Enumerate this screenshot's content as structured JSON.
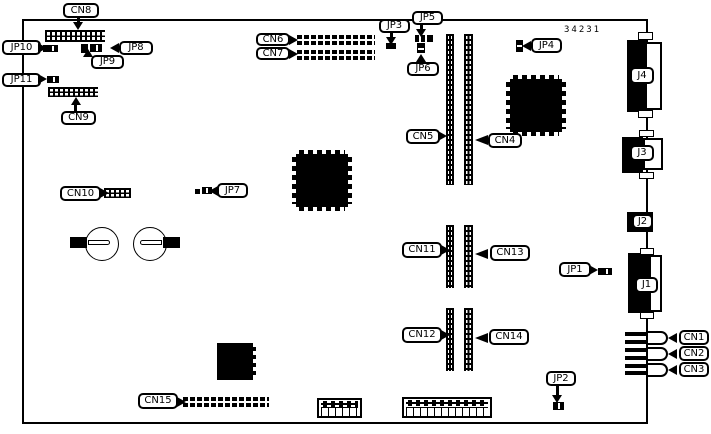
{
  "figure": "pcb-component-location-diagram",
  "part_number": "34231",
  "colors": {
    "ink": "#000000",
    "background": "#ffffff"
  },
  "labels": {
    "cn1": "CN1",
    "cn2": "CN2",
    "cn3": "CN3",
    "cn4": "CN4",
    "cn5": "CN5",
    "cn6": "CN6",
    "cn7": "CN7",
    "cn8": "CN8",
    "cn9": "CN9",
    "cn10": "CN10",
    "cn11": "CN11",
    "cn12": "CN12",
    "cn13": "CN13",
    "cn14": "CN14",
    "cn15": "CN15",
    "jp1": "JP1",
    "jp2": "JP2",
    "jp3": "JP3",
    "jp4": "JP4",
    "jp5": "JP5",
    "jp6": "JP6",
    "jp7": "JP7",
    "jp8": "JP8",
    "jp9": "JP9",
    "jp10": "JP10",
    "jp11": "JP11",
    "j1": "J1",
    "j2": "J2",
    "j3": "J3",
    "j4": "J4"
  }
}
